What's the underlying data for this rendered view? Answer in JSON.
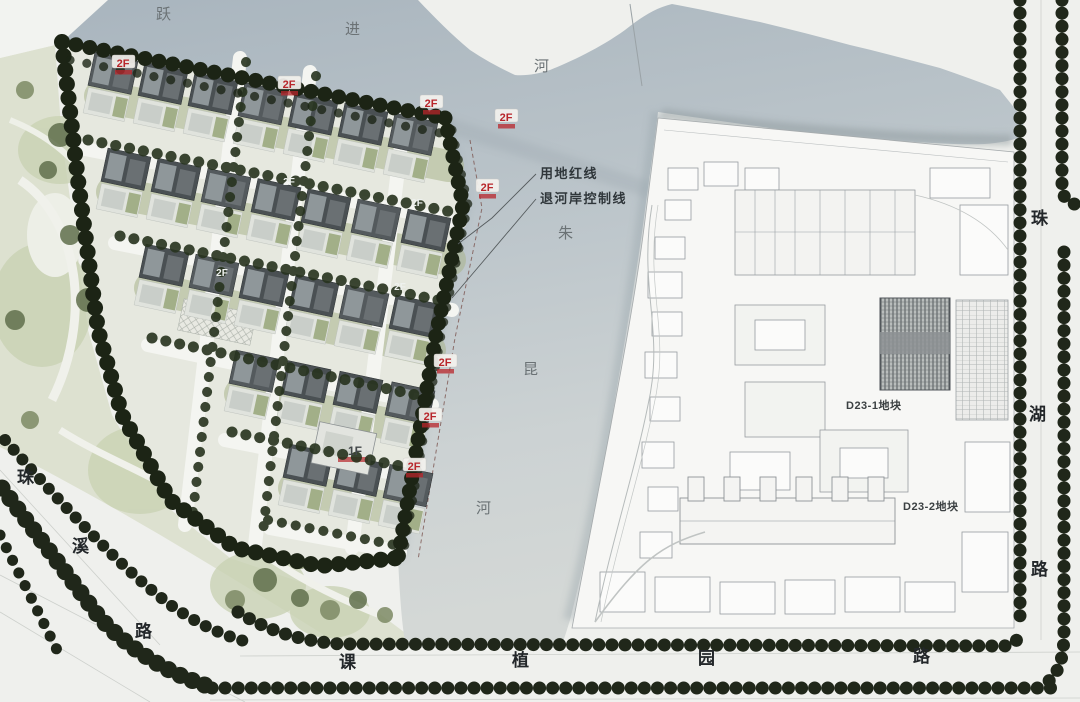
{
  "map_texts": {
    "river_yuejin": {
      "name": "跃进河",
      "chars": [
        "跃",
        "进",
        "河"
      ]
    },
    "river_zhukun": {
      "name": "朱昆河",
      "chars": [
        "朱",
        "昆",
        "河"
      ]
    },
    "road_zhuxi": {
      "name": "珠溪路",
      "chars": [
        "珠",
        "溪",
        "路"
      ]
    },
    "road_kezhiyuan": {
      "name": "课植园路",
      "chars": [
        "课",
        "植",
        "园",
        "路"
      ]
    },
    "road_zhuhu": {
      "name": "珠湖路",
      "chars": [
        "珠",
        "湖",
        "路"
      ]
    }
  },
  "annotations": {
    "land_red_line": "用地红线",
    "riverbank_setback": "退河岸控制线"
  },
  "parcels": {
    "d23_1": "D23-1地块",
    "d23_2": "D23-2地块"
  },
  "building_labels": [
    {
      "text": "2F",
      "x": 123,
      "y": 64,
      "style": "red"
    },
    {
      "text": "2F",
      "x": 289,
      "y": 85,
      "style": "red"
    },
    {
      "text": "2F",
      "x": 431,
      "y": 104,
      "style": "red"
    },
    {
      "text": "2F",
      "x": 506,
      "y": 118,
      "style": "red"
    },
    {
      "text": "2F",
      "x": 487,
      "y": 188,
      "style": "red"
    },
    {
      "text": "2F",
      "x": 445,
      "y": 363,
      "style": "red"
    },
    {
      "text": "2F",
      "x": 430,
      "y": 417,
      "style": "red"
    },
    {
      "text": "2F",
      "x": 414,
      "y": 467,
      "style": "red"
    },
    {
      "text": "2F",
      "x": 289,
      "y": 182,
      "style": "white"
    },
    {
      "text": "2F",
      "x": 400,
      "y": 287,
      "style": "white"
    },
    {
      "text": "2F",
      "x": 222,
      "y": 273,
      "style": "white"
    },
    {
      "text": "2F",
      "x": 417,
      "y": 203,
      "style": "white"
    },
    {
      "text": "1F",
      "x": 355,
      "y": 452,
      "style": "dark"
    }
  ],
  "colors": {
    "red_label": "#b8262b",
    "river": "#b7c2c9",
    "park": "#dde1d2",
    "street_tree": "#20271a",
    "site_red_line": "#a0342f",
    "plan_fill": "#f7f7f5"
  }
}
